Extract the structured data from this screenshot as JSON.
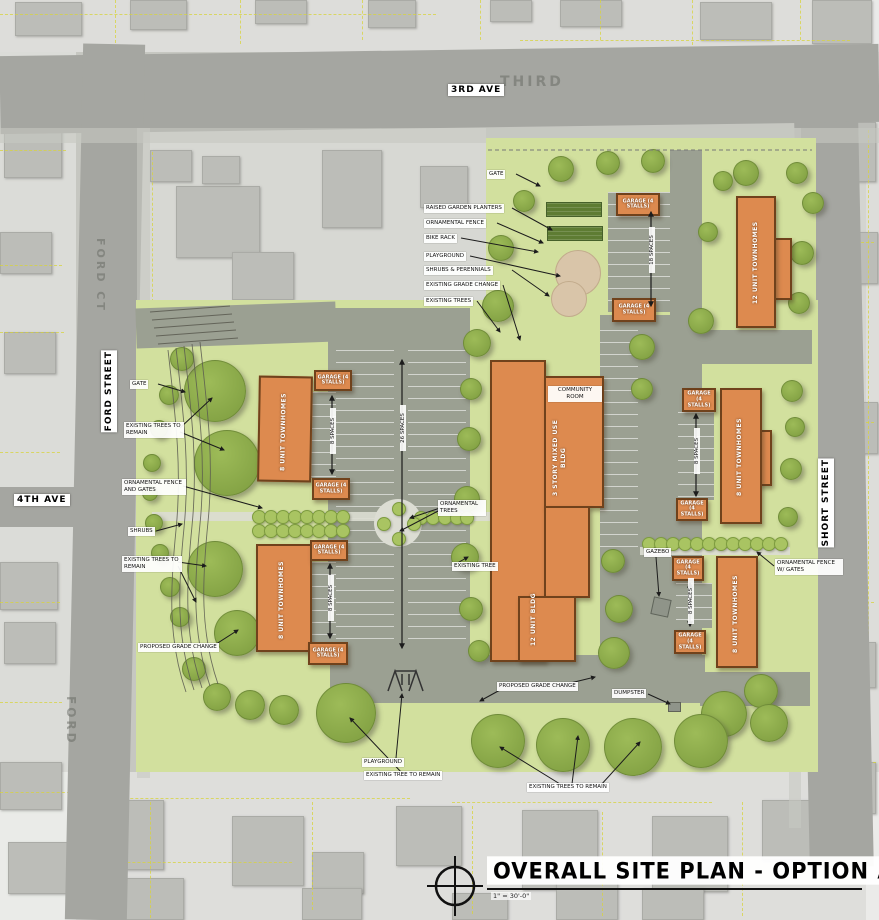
{
  "title_block": {
    "title": "OVERALL SITE PLAN - OPTION A",
    "scale": "1\" = 30'-0\""
  },
  "streets": {
    "third_ave": "3RD AVE",
    "third_faint": "THIRD",
    "ford_ct": "FORD CT",
    "ford_street": "FORD STREET",
    "fourth_ave": "4TH AVE",
    "ford": "FORD",
    "short_street": "SHORT STREET"
  },
  "callouts": {
    "north": [
      {
        "text": "GATE"
      },
      {
        "text": "RAISED GARDEN PLANTERS"
      },
      {
        "text": "ORNAMENTAL FENCE"
      },
      {
        "text": "BIKE RACK"
      },
      {
        "text": "PLAYGROUND"
      },
      {
        "text": "SHRUBS & PERENNIALS"
      },
      {
        "text": "EXISTING GRADE CHANGE"
      },
      {
        "text": "EXISTING TREES"
      }
    ],
    "west": [
      {
        "text": "GATE"
      },
      {
        "text": "EXISTING TREES TO REMAIN"
      },
      {
        "text": "ORNAMENTAL FENCE AND GATES"
      },
      {
        "text": "SHRUBS"
      },
      {
        "text": "EXISTING TREES TO REMAIN"
      },
      {
        "text": "PROPOSED GRADE CHANGE"
      }
    ],
    "center": [
      {
        "text": "ORNAMENTAL TREES"
      },
      {
        "text": "EXISTING TREE"
      }
    ],
    "south": [
      {
        "text": "PROPOSED GRADE CHANGE"
      },
      {
        "text": "DUMPSTER"
      },
      {
        "text": "GAZEBO"
      },
      {
        "text": "PLAYGROUND"
      },
      {
        "text": "EXISTING TREE TO REMAIN"
      },
      {
        "text": "EXISTING TREES TO REMAIN"
      }
    ],
    "east": [
      {
        "text": "ORNAMENTAL FENCE W/ GATES"
      }
    ]
  },
  "buildings": {
    "community_room": "COMMUNITY ROOM",
    "central_upper": "3 STORY MIXED USE BLDG",
    "central_lower": "12 UNIT BLDG",
    "northeast": "12 UNIT TOWNHOMES",
    "west_upper": "8 UNIT TOWNHOMES",
    "west_lower": "8 UNIT TOWNHOMES",
    "east_upper": "8 UNIT TOWNHOMES",
    "east_lower": "8 UNIT TOWNHOMES",
    "garage": "GARAGE (4 STALLS)"
  },
  "parking": {
    "north": "18 SPACES",
    "central": "26 SPACES",
    "small": "8 SPACES"
  },
  "colors": {
    "building_orange": "#dd8a4f",
    "building_outline": "#70421c",
    "site_green": "#d2e09e",
    "tree_green": "#7d9c3f",
    "parking_gray": "#9ba092",
    "road_gray": "#a5a6a1",
    "planter_green": "#5e7c33",
    "playground_tan": "#d9c5a9",
    "parcel_yellow": "#d8d43c",
    "label_bg": "#ffffff"
  }
}
